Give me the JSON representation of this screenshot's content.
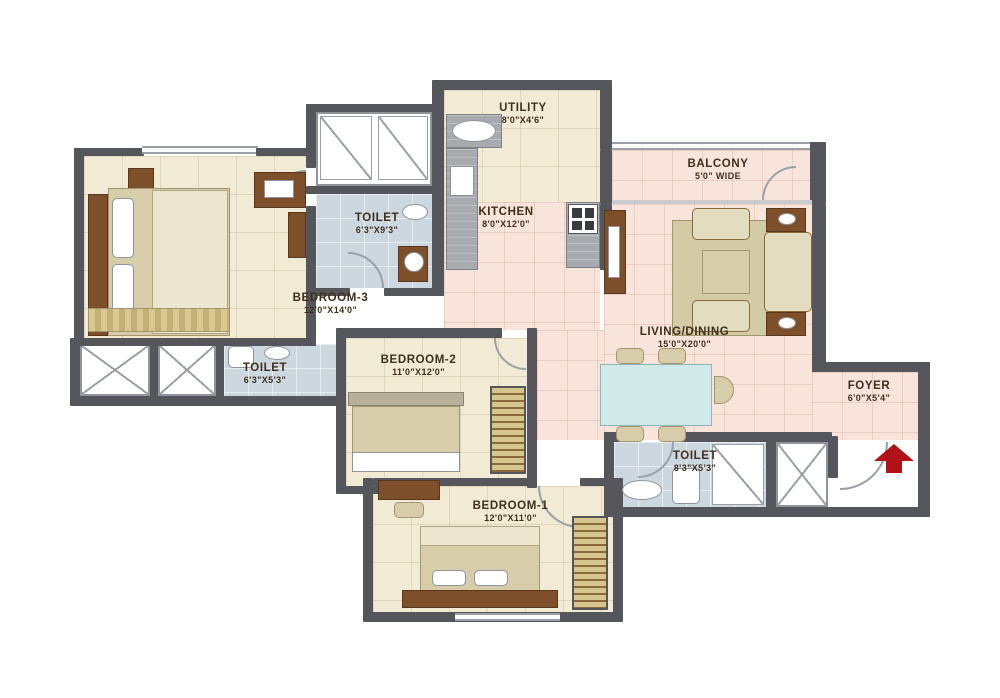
{
  "plan": {
    "colors": {
      "wall": "#54565b",
      "floor_cream": "#f1ebd5",
      "floor_pink": "#f8e4da",
      "floor_blue": "#ccd7e0",
      "entry_arrow_red": "#b01218"
    },
    "rooms": [
      {
        "name": "UTILITY",
        "dims": "8'0\"X4'6\""
      },
      {
        "name": "BALCONY",
        "dims": "5'0\" WIDE"
      },
      {
        "name": "TOILET",
        "dims": "6'3\"X9'3\""
      },
      {
        "name": "KITCHEN",
        "dims": "8'0\"X12'0\""
      },
      {
        "name": "BEDROOM-3",
        "dims": "12'0\"X14'0\""
      },
      {
        "name": "LIVING/DINING",
        "dims": "15'0\"X20'0\""
      },
      {
        "name": "TOILET",
        "dims": "6'3\"X5'3\""
      },
      {
        "name": "BEDROOM-2",
        "dims": "11'0\"X12'0\""
      },
      {
        "name": "FOYER",
        "dims": "6'0\"X5'4\""
      },
      {
        "name": "TOILET",
        "dims": "8'3\"X5'3\""
      },
      {
        "name": "BEDROOM-1",
        "dims": "12'0\"X11'0\""
      }
    ],
    "entry": {
      "direction": "up"
    }
  }
}
